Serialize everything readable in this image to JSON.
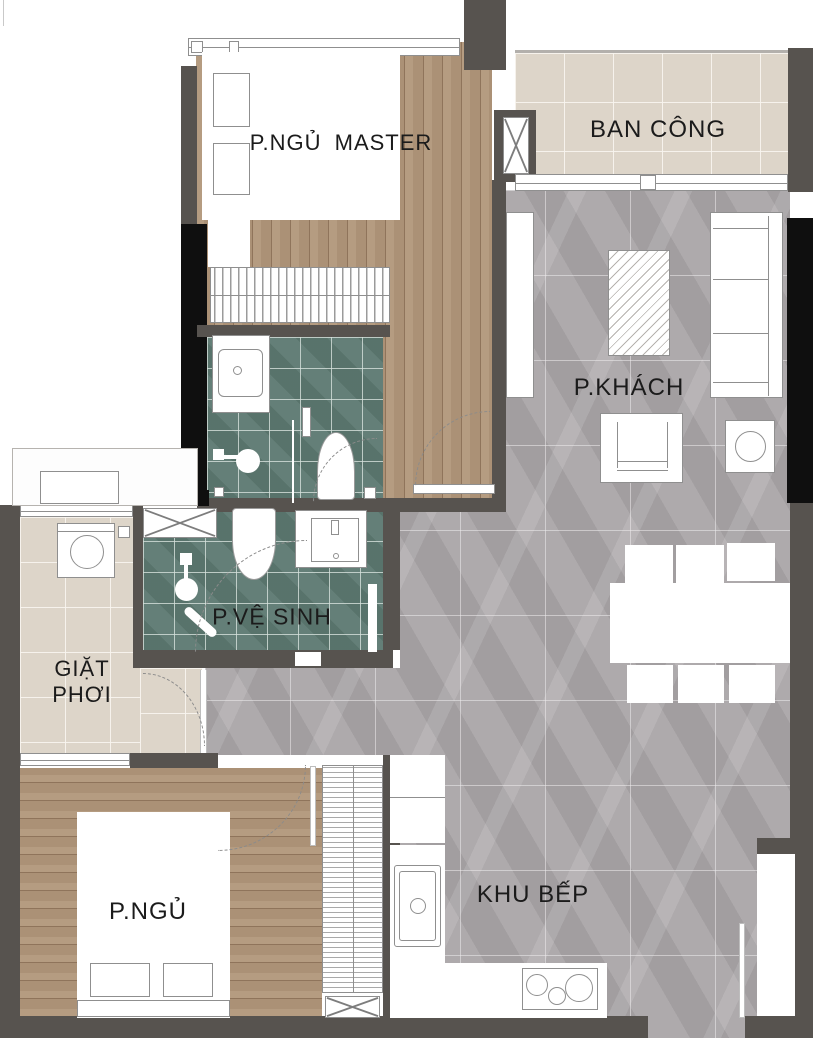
{
  "title": "Apartment floor plan",
  "colors": {
    "wall": "#57534f",
    "wall_black": "#0f0f0f",
    "wood": "#b09678",
    "marble": "#a7a3a5",
    "tile_green": "#5e7a72",
    "tile_beige": "#ddd5c9",
    "line": "#8f8f8f",
    "text": "#1b1b1b"
  },
  "rooms": {
    "master_bedroom": {
      "label": "P.NGỦ MASTER"
    },
    "balcony": {
      "label": "BAN CÔNG"
    },
    "living_room": {
      "label": "P.KHÁCH"
    },
    "bathroom": {
      "label": "P.VỆ SINH"
    },
    "laundry": {
      "label_line1": "GIẶT",
      "label_line2": "PHƠI"
    },
    "bedroom2": {
      "label": "P.NGỦ"
    },
    "kitchen": {
      "label": "KHU BẾP"
    }
  }
}
